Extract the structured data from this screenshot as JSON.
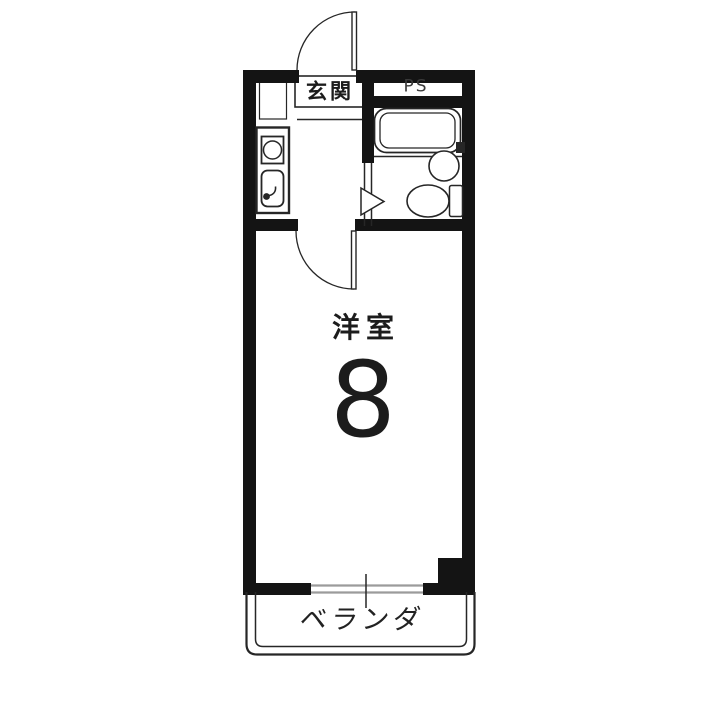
{
  "floor_plan": {
    "type": "apartment-1K-floor-plan",
    "labels": {
      "entrance": "玄関",
      "pipe_space": "PS",
      "room": "洋室",
      "room_size": "8",
      "veranda": "ベランダ"
    },
    "fixtures": [
      "entrance-door",
      "room-door",
      "bathroom-folding-door",
      "bathtub",
      "wash-basin",
      "toilet",
      "bath-faucet",
      "stove",
      "kitchen-sink",
      "shoe-cabinet",
      "window",
      "pillar",
      "veranda"
    ],
    "colors": {
      "wall": "#141414",
      "line": "#262626",
      "window": "#9b9b9b",
      "background": "#ffffff",
      "text": "#1c1c1c",
      "subtext": "#3a3a3a"
    }
  }
}
